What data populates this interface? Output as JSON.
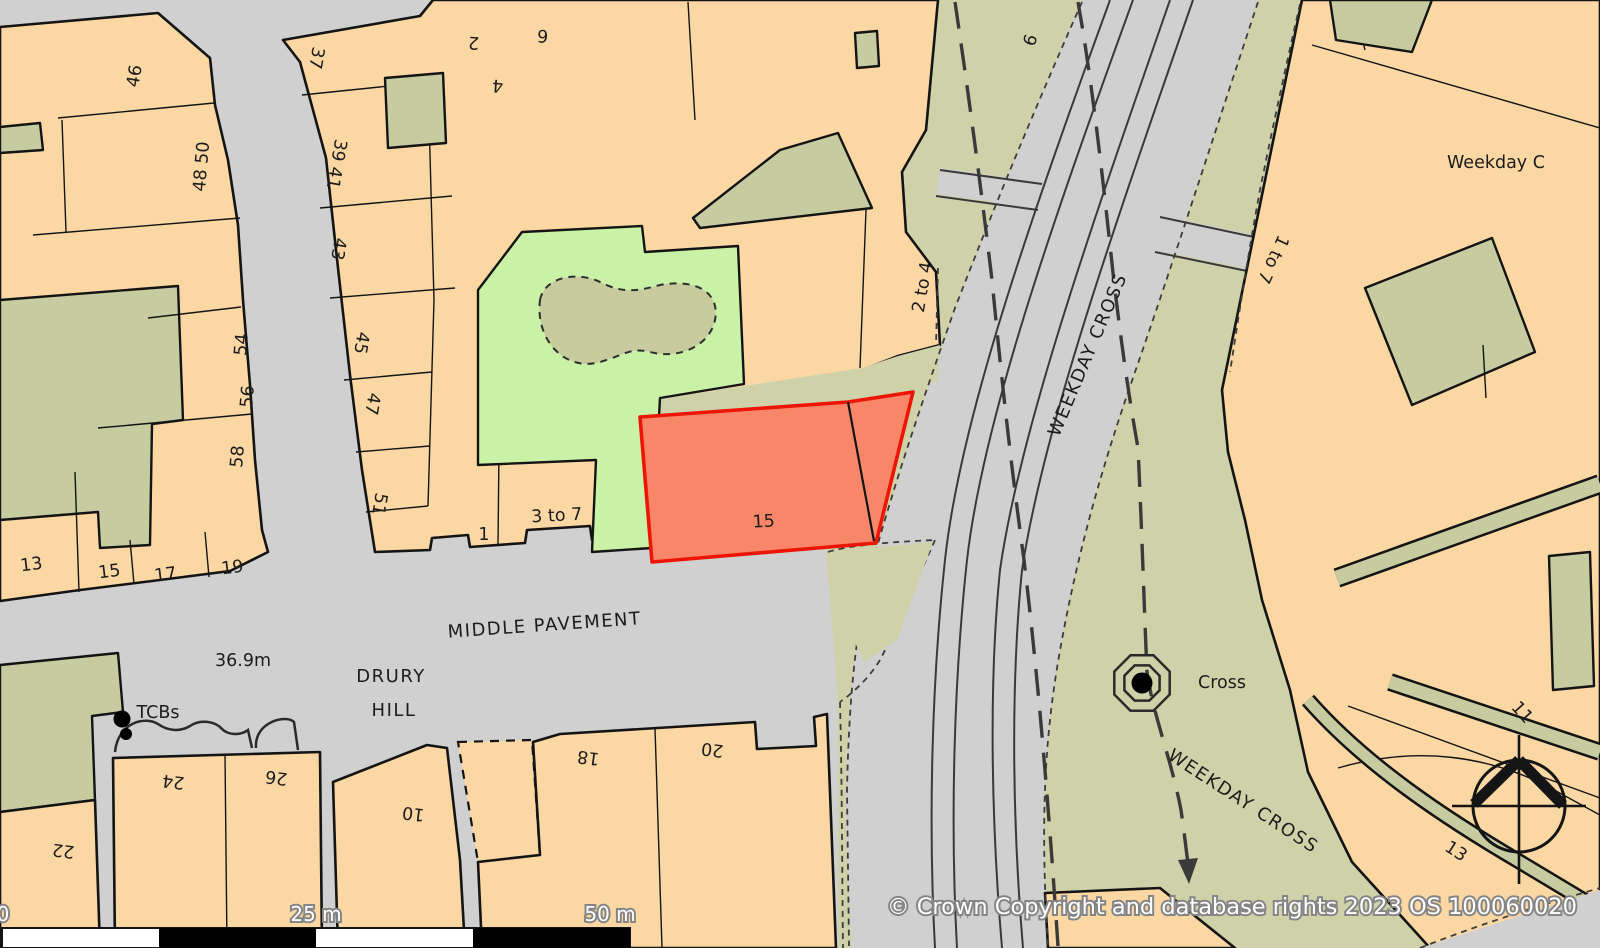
{
  "map": {
    "attribution": "© Crown Copyright and database rights 2023 OS 100060020",
    "scale_bar": {
      "start": "0",
      "mid": "25 m",
      "end": "50 m"
    },
    "streets": {
      "middle_pavement": "MIDDLE PAVEMENT",
      "drury": "DRURY",
      "hill": "HILL",
      "weekday_cross_upper": "WEEKDAY CROSS",
      "weekday_cross_lower": "WEEKDAY CROSS",
      "weekday_c_truncated": "Weekday C"
    },
    "poi": {
      "cross": "Cross",
      "tcbs": "TCBs",
      "spot_height": "36.9m"
    },
    "highlight_parcel": {
      "label": "15"
    },
    "numbers": {
      "n46": "46",
      "n48_50": "48 50",
      "n54": "54",
      "n56": "56",
      "n58": "58",
      "n13w": "13",
      "n15w": "15",
      "n17": "17",
      "n19": "19",
      "n22": "22",
      "n24": "24",
      "n26": "26",
      "n37": "37",
      "n39_41": "39 41",
      "n43": "43",
      "n45": "45",
      "n47": "47",
      "n51": "51",
      "n1": "1",
      "n3to7": "3 to 7",
      "n2": "2",
      "n4": "4",
      "n6top": "6",
      "n6road": "6",
      "n2to4": "2 to 4",
      "n10": "10",
      "n18": "18",
      "n20": "20",
      "n1to7": "1 to 7",
      "n11": "11",
      "n13e": "13"
    },
    "colors": {
      "building_fill": "#fbd7a4",
      "khaki_fill": "#c6cba0",
      "verge_fill": "#cfd2a9",
      "green_space_fill": "#c9f2a6",
      "road_fill": "#d0d0d0",
      "highlight_fill": "#f8876a",
      "highlight_stroke": "#ee1507",
      "outline": "#141414"
    }
  }
}
